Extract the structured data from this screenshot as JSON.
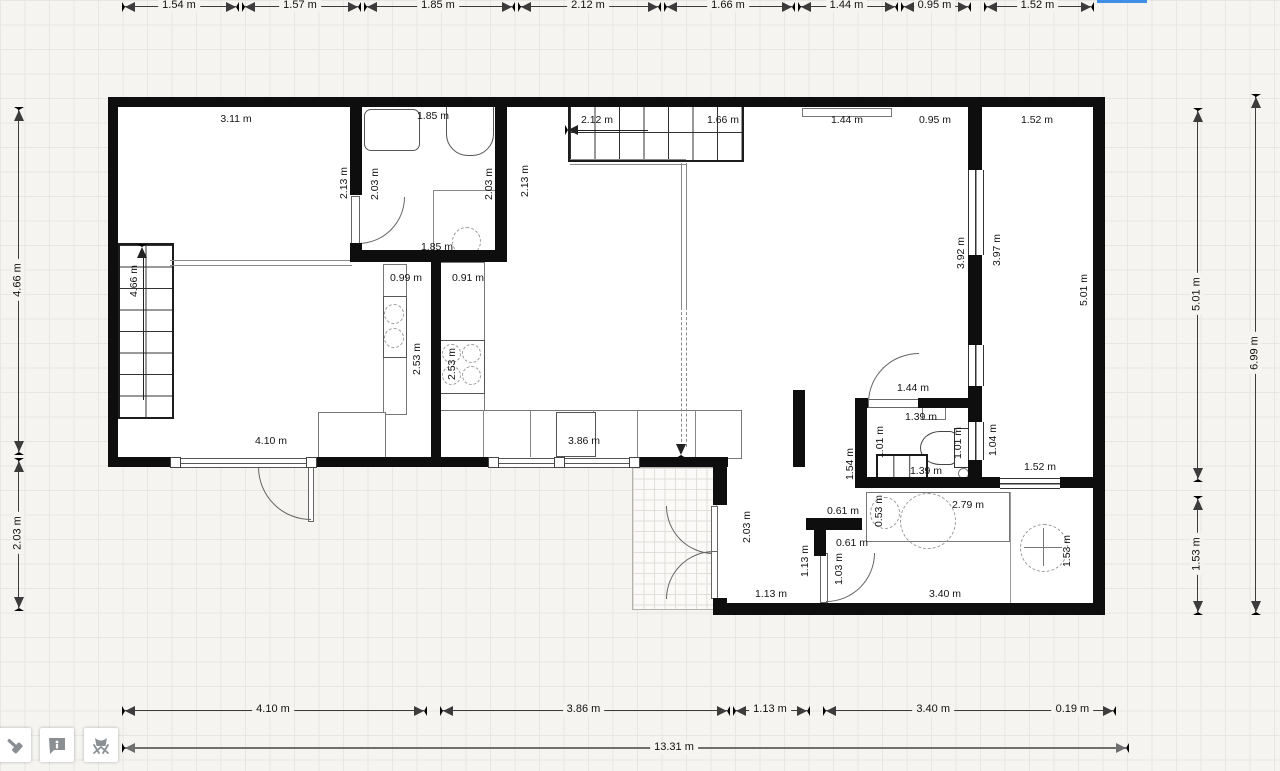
{
  "app": {
    "view": "floor-plan-canvas"
  },
  "colors": {
    "wall": "#0e0e0e",
    "selection_blue": "#2b5fd0",
    "selection_bar": "#3f8ee8",
    "dim_line": "#3c3c3c",
    "overall_line": "#6f6f6f",
    "grid": "#e8e6e2",
    "page_bg": "#f5f4f1",
    "icon_gray": "#8a8f94"
  },
  "toolbar": {
    "buttons": [
      {
        "id": "build-tool",
        "icon": "hammer-icon"
      },
      {
        "id": "info-tool",
        "icon": "info-bubble-icon"
      },
      {
        "id": "furniture-tool",
        "icon": "chair-icon"
      }
    ]
  },
  "dims": {
    "top": [
      [
        122,
        236,
        "1.54 m"
      ],
      [
        242,
        358,
        "1.57 m"
      ],
      [
        364,
        512,
        "1.85 m"
      ],
      [
        518,
        658,
        "2.12 m"
      ],
      [
        664,
        792,
        "1.66 m"
      ],
      [
        798,
        895,
        "1.44 m"
      ],
      [
        901,
        968,
        "0.95 m"
      ],
      [
        984,
        1091,
        "1.52 m"
      ]
    ],
    "bottom": [
      [
        122,
        424,
        "4.10 m"
      ],
      [
        440,
        727,
        "3.86 m"
      ],
      [
        733,
        807,
        "1.13 m"
      ],
      [
        823,
        1113,
        "3.40 m",
        0.38,
        "0.19 m",
        0.86
      ]
    ],
    "left": [
      [
        107,
        452,
        "4.66 m"
      ],
      [
        458,
        608,
        "2.03 m"
      ]
    ],
    "right_inner": [
      [
        108,
        479,
        "5.01 m"
      ],
      [
        496,
        612,
        "1.53 m"
      ]
    ],
    "right_outer": [
      [
        94,
        612,
        "6.99 m"
      ]
    ],
    "overall": {
      "y": 747,
      "x1": 122,
      "x2": 1126,
      "label": "13.31 m"
    }
  },
  "room_labels": [
    [
      236,
      119,
      "3.11 m",
      0
    ],
    [
      433,
      116,
      "1.85 m",
      0
    ],
    [
      597,
      120,
      "2.12 m",
      0
    ],
    [
      723,
      120,
      "1.66 m",
      0
    ],
    [
      847,
      120,
      "1.44 m",
      0
    ],
    [
      935,
      120,
      "0.95 m",
      0
    ],
    [
      1037,
      120,
      "1.52 m",
      0
    ],
    [
      134,
      281,
      "4.66 m",
      1
    ],
    [
      344,
      183,
      "2.13 m",
      1
    ],
    [
      375,
      184,
      "2.03 m",
      1
    ],
    [
      489,
      184,
      "2.03 m",
      1
    ],
    [
      525,
      181,
      "2.13 m",
      1
    ],
    [
      437,
      247,
      "1.85 m",
      0
    ],
    [
      406,
      278,
      "0.99 m",
      0
    ],
    [
      468,
      278,
      "0.91 m",
      0
    ],
    [
      417,
      359,
      "2.53 m",
      1
    ],
    [
      452,
      364,
      "2.53 m",
      1
    ],
    [
      961,
      253,
      "3.92 m",
      1
    ],
    [
      997,
      250,
      "3.97 m",
      1
    ],
    [
      1084,
      290,
      "5.01 m",
      1
    ],
    [
      271,
      441,
      "4.10 m",
      0
    ],
    [
      584,
      441,
      "3.86 m",
      0
    ],
    [
      913,
      388,
      "1.44 m",
      0
    ],
    [
      921,
      417,
      "1.39 m",
      0
    ],
    [
      850,
      464,
      "1.54 m",
      1
    ],
    [
      880,
      442,
      "1.01 m",
      1
    ],
    [
      958,
      443,
      "1.01 m",
      1
    ],
    [
      993,
      440,
      "1.04 m",
      1
    ],
    [
      926,
      471,
      "1.39 m",
      0
    ],
    [
      1040,
      467,
      "1.52 m",
      0
    ],
    [
      747,
      527,
      "2.03 m",
      1
    ],
    [
      843,
      511,
      "0.61 m",
      0
    ],
    [
      879,
      511,
      "0.53 m",
      1
    ],
    [
      968,
      505,
      "2.79 m",
      0
    ],
    [
      805,
      561,
      "1.13 m",
      1
    ],
    [
      852,
      543,
      "0.61 m",
      0
    ],
    [
      839,
      569,
      "1.03 m",
      1
    ],
    [
      771,
      594,
      "1.13 m",
      0
    ],
    [
      945,
      594,
      "3.40 m",
      0
    ],
    [
      1067,
      551,
      "1.53 m",
      1
    ]
  ],
  "plan": {
    "floors": [
      [
        108,
        97,
        997,
        370
      ],
      [
        715,
        467,
        390,
        148
      ]
    ],
    "tiles": [
      632,
      467,
      83,
      141
    ],
    "walls": [
      [
        108,
        97,
        997,
        10
      ],
      [
        108,
        107,
        10,
        360
      ],
      [
        118,
        457,
        54,
        10
      ],
      [
        313,
        457,
        177,
        10
      ],
      [
        633,
        457,
        95,
        10
      ],
      [
        1093,
        107,
        12,
        508
      ],
      [
        713,
        467,
        14,
        38
      ],
      [
        713,
        598,
        14,
        17
      ],
      [
        727,
        603,
        366,
        12
      ],
      [
        350,
        107,
        12,
        88
      ],
      [
        350,
        243,
        12,
        19
      ],
      [
        350,
        250,
        157,
        12
      ],
      [
        495,
        107,
        12,
        143
      ],
      [
        431,
        262,
        10,
        195
      ],
      [
        968,
        107,
        14,
        63
      ],
      [
        968,
        255,
        14,
        90
      ],
      [
        968,
        386,
        14,
        36
      ],
      [
        968,
        460,
        14,
        23
      ],
      [
        793,
        390,
        12,
        77
      ],
      [
        855,
        398,
        13,
        10
      ],
      [
        918,
        398,
        52,
        10
      ],
      [
        855,
        408,
        12,
        75
      ],
      [
        855,
        477,
        145,
        11
      ],
      [
        1060,
        477,
        33,
        11
      ],
      [
        806,
        518,
        56,
        12
      ],
      [
        814,
        530,
        12,
        26
      ]
    ],
    "windows_v": [
      [
        968,
        170,
        14,
        85
      ],
      [
        968,
        345,
        14,
        41
      ],
      [
        968,
        422,
        14,
        38
      ]
    ],
    "windows_h": [
      [
        1000,
        478,
        60,
        9
      ]
    ],
    "sliders": [
      [
        172,
        458,
        141,
        8
      ],
      [
        490,
        458,
        143,
        8
      ]
    ],
    "handles": [
      [
        170,
        457
      ],
      [
        306,
        457
      ],
      [
        488,
        457
      ],
      [
        554,
        457
      ],
      [
        629,
        457
      ]
    ],
    "items": [
      {
        "t": "stairsv",
        "n": "staircase",
        "x": 118,
        "y": 243,
        "w": 52,
        "h": 172,
        "step": 21.5
      },
      {
        "t": "stairsh",
        "n": "staircase",
        "x": 568,
        "y": 103,
        "w": 172,
        "h": 55,
        "step": 24.5
      },
      {
        "t": "rrect",
        "n": "washing-machine",
        "x": 364,
        "y": 109,
        "w": 54,
        "h": 40
      },
      {
        "t": "tub",
        "n": "bathtub",
        "x": 446,
        "y": 101,
        "w": 46,
        "h": 53
      },
      {
        "t": "cdash",
        "n": "toilet-cistern",
        "x": 452,
        "y": 227,
        "w": 27,
        "h": 27
      },
      {
        "t": "rect",
        "n": "toilet-base",
        "x": 456,
        "y": 252,
        "w": 19,
        "h": 5,
        "c": "#999"
      },
      {
        "t": "rect",
        "n": "kitchen-counter-left",
        "x": 383,
        "y": 264,
        "w": 22,
        "h": 149
      },
      {
        "t": "rect",
        "n": "kitchen-sink-box",
        "x": 383,
        "y": 296,
        "w": 22,
        "h": 60,
        "c": "#555"
      },
      {
        "t": "cdash",
        "n": "sink-basin",
        "x": 384,
        "y": 304,
        "w": 18,
        "h": 18
      },
      {
        "t": "cdash",
        "n": "sink-basin",
        "x": 384,
        "y": 328,
        "w": 18,
        "h": 18
      },
      {
        "t": "rect",
        "n": "kitchen-island",
        "x": 438,
        "y": 262,
        "w": 45,
        "h": 150
      },
      {
        "t": "rect",
        "n": "stove",
        "x": 438,
        "y": 340,
        "w": 45,
        "h": 52,
        "c": "#555"
      },
      {
        "t": "cdash",
        "n": "stove-burner",
        "x": 442,
        "y": 344,
        "w": 17,
        "h": 17
      },
      {
        "t": "cdash",
        "n": "stove-burner",
        "x": 462,
        "y": 344,
        "w": 17,
        "h": 17
      },
      {
        "t": "cdash",
        "n": "stove-burner",
        "x": 442,
        "y": 366,
        "w": 17,
        "h": 17
      },
      {
        "t": "cdash",
        "n": "stove-burner",
        "x": 462,
        "y": 366,
        "w": 17,
        "h": 17
      },
      {
        "t": "rect",
        "n": "kitchen-cabinet-row",
        "x": 438,
        "y": 410,
        "w": 302,
        "h": 47
      },
      {
        "t": "vline",
        "n": "cabinet-divider",
        "x": 483,
        "y": 410,
        "h": 47,
        "c": "#888"
      },
      {
        "t": "vline",
        "n": "cabinet-divider",
        "x": 530,
        "y": 410,
        "h": 47,
        "c": "#888"
      },
      {
        "t": "vline",
        "n": "cabinet-divider",
        "x": 593,
        "y": 410,
        "h": 47,
        "c": "#888"
      },
      {
        "t": "vline",
        "n": "cabinet-divider",
        "x": 637,
        "y": 410,
        "h": 47,
        "c": "#888"
      },
      {
        "t": "vline",
        "n": "cabinet-divider",
        "x": 695,
        "y": 410,
        "h": 47,
        "c": "#888"
      },
      {
        "t": "rect",
        "n": "cabinet-inner",
        "x": 556,
        "y": 412,
        "w": 38,
        "h": 43,
        "c": "#555"
      },
      {
        "t": "rect",
        "n": "sideboard",
        "x": 318,
        "y": 412,
        "w": 66,
        "h": 45
      },
      {
        "t": "rect",
        "n": "radiator-top-wall",
        "x": 802,
        "y": 108,
        "w": 88,
        "h": 7
      },
      {
        "t": "rect",
        "n": "wc-sink",
        "x": 922,
        "y": 403,
        "w": 22,
        "h": 15
      },
      {
        "t": "ellipse",
        "n": "wc-toilet-bowl",
        "x": 920,
        "y": 431,
        "w": 38,
        "h": 32
      },
      {
        "t": "rect",
        "n": "wc-toilet-tank",
        "x": 954,
        "y": 428,
        "w": 13,
        "h": 38,
        "c": "#333"
      },
      {
        "t": "radiator",
        "n": "wc-radiator",
        "x": 876,
        "y": 454,
        "w": 48,
        "h": 28
      },
      {
        "t": "dotc",
        "n": "door-knob",
        "x": 958,
        "y": 468,
        "w": 9,
        "h": 9
      },
      {
        "t": "rect",
        "n": "bathroom-counter",
        "x": 866,
        "y": 492,
        "w": 142,
        "h": 48
      },
      {
        "t": "cdash",
        "n": "washbasin-small",
        "x": 870,
        "y": 497,
        "w": 28,
        "h": 30
      },
      {
        "t": "cdash",
        "n": "washbasin-large",
        "x": 900,
        "y": 493,
        "w": 54,
        "h": 54
      },
      {
        "t": "cdash",
        "n": "shower-tray",
        "x": 1020,
        "y": 524,
        "w": 46,
        "h": 46
      },
      {
        "t": "cross",
        "n": "shower-drain",
        "x": 1024,
        "y": 528,
        "w": 38,
        "h": 38
      },
      {
        "t": "vline",
        "n": "shower-divider",
        "x": 1010,
        "y": 492,
        "h": 111,
        "c": "#999"
      },
      {
        "t": "vline",
        "n": "shower-corner-line",
        "x": 433,
        "y": 190,
        "h": 62,
        "c": "#888"
      },
      {
        "t": "hline",
        "n": "shower-corner-line",
        "x": 433,
        "y": 190,
        "w": 62,
        "c": "#888"
      },
      {
        "t": "dblh",
        "n": "room-divider",
        "x": 170,
        "y": 260,
        "w": 182
      },
      {
        "t": "dblh",
        "n": "stair-railing",
        "x": 570,
        "y": 159,
        "w": 116
      },
      {
        "t": "dblv",
        "n": "stair-railing",
        "x": 681,
        "y": 163,
        "h": 144
      },
      {
        "t": "dashv",
        "n": "stair-guide-line",
        "x": 681,
        "y": 307,
        "h": 140
      },
      {
        "t": "tri",
        "n": "stair-direction-arrow",
        "dir": "down",
        "x": 676,
        "y": 444
      },
      {
        "t": "vline",
        "n": "stair-arrow-line",
        "x": 143,
        "y": 254,
        "h": 146,
        "c": "#222"
      },
      {
        "t": "tri",
        "n": "stair-direction-arrow",
        "dir": "up",
        "x": 137,
        "y": 244
      },
      {
        "t": "hline",
        "n": "stair-arrow-line",
        "x": 578,
        "y": 130,
        "w": 70,
        "c": "#222"
      },
      {
        "t": "tri",
        "n": "stair-direction-arrow",
        "dir": "left",
        "x": 565,
        "y": 125
      },
      {
        "t": "leafv",
        "n": "door-leaf",
        "x": 351,
        "y": 196,
        "w": 7,
        "h": 47
      },
      {
        "t": "arc",
        "n": "door-swing",
        "corner": "br",
        "x": 358,
        "y": 197,
        "w": 46,
        "h": 46
      },
      {
        "t": "leafv",
        "n": "door-leaf",
        "x": 308,
        "y": 467,
        "w": 4,
        "h": 53
      },
      {
        "t": "arc",
        "n": "door-swing",
        "corner": "bl",
        "x": 258,
        "y": 467,
        "w": 52,
        "h": 52
      },
      {
        "t": "leafv",
        "n": "double-door-leaf",
        "x": 711,
        "y": 506,
        "w": 5,
        "h": 46
      },
      {
        "t": "arc",
        "n": "door-swing",
        "corner": "bl",
        "x": 666,
        "y": 506,
        "w": 47,
        "h": 47
      },
      {
        "t": "leafv",
        "n": "double-door-leaf",
        "x": 711,
        "y": 551,
        "w": 5,
        "h": 46
      },
      {
        "t": "arc",
        "n": "door-swing",
        "corner": "tl",
        "x": 666,
        "y": 551,
        "w": 47,
        "h": 47
      },
      {
        "t": "leafh",
        "n": "door-leaf",
        "x": 868,
        "y": 399,
        "w": 50,
        "h": 7
      },
      {
        "t": "arc",
        "n": "door-swing",
        "corner": "tl",
        "x": 868,
        "y": 353,
        "w": 50,
        "h": 49
      },
      {
        "t": "leafv",
        "n": "door-leaf",
        "x": 820,
        "y": 553,
        "w": 6,
        "h": 48
      },
      {
        "t": "arc",
        "n": "door-swing",
        "corner": "br",
        "x": 826,
        "y": 553,
        "w": 48,
        "h": 48
      },
      {
        "t": "hatch",
        "n": "selected-wall-highlight",
        "x": 495,
        "y": 113,
        "w": 12,
        "h": 62
      },
      {
        "t": "bluebar",
        "n": "selection-bar",
        "x": 1097,
        "y": 0,
        "w": 50,
        "h": 3
      }
    ]
  }
}
